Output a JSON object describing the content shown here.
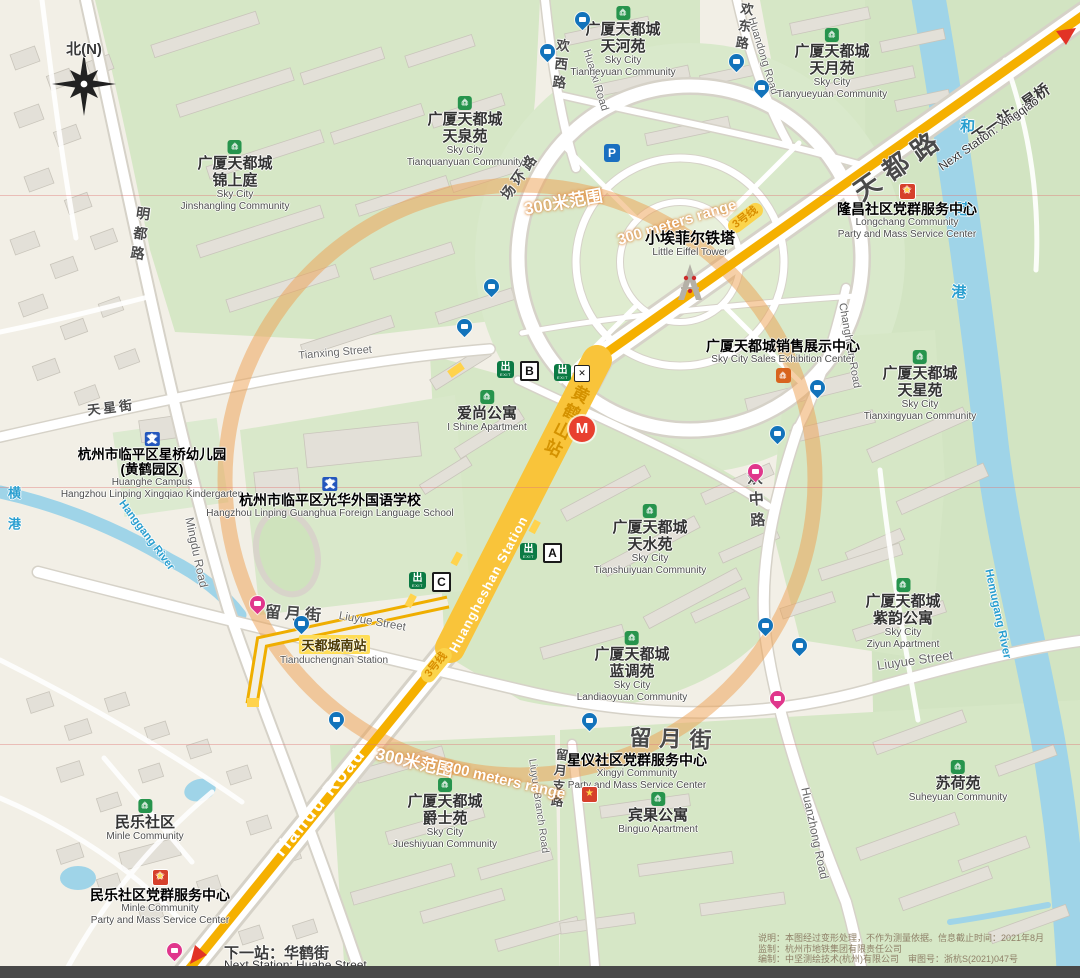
{
  "compass": {
    "label": "北(N)"
  },
  "parking_label": "P",
  "metro": {
    "logo": "M",
    "line_badge": "3号线",
    "station_zh": "黄鹤山站",
    "station_en": "Huangheshan Station"
  },
  "exits": {
    "glyph": "出",
    "sub": "EXIT",
    "a": "A",
    "b": "B",
    "c": "C",
    "elevator_glyph": "✕"
  },
  "range_circle": {
    "zh": "300米范围",
    "en": "300 meters range"
  },
  "next_station_ne": {
    "zh": "下一站：星桥",
    "en": "Next Station: Xingqiao"
  },
  "next_station_sw": {
    "zh": "下一站：华鹤街",
    "en": "Next Station: Huahe Street"
  },
  "bus_station": {
    "zh": "天都城南站",
    "en": "Tianduchengnan Station"
  },
  "landmark": {
    "zh": "小埃菲尔铁塔",
    "en": "Little Eiffel Tower"
  },
  "roads": {
    "tiandu_zh": "天都路",
    "tiandu_en": "Tiandu Road",
    "mingdu_zh": "明都路",
    "mingdu_en": "Mingdu Road",
    "tianxing_zh": "天星街",
    "tianxing_en": "Tianxing Street",
    "huanxi_zh": "欢西路",
    "huanxi_en": "Huanxi Road",
    "huandong_zh": "欢东路",
    "huandong_en": "Huandong Road",
    "changhuan_zh": "场环路",
    "changhuan_en": "Changhuan Road",
    "huanzhong_zh": "欢中路",
    "huanzhong_en": "Huanzhong Road",
    "liuyue_zh": "留月街",
    "liuyue_en": "Liuyue Street",
    "liuyue_branch_zh": "留月支路",
    "liuyue_branch_en": "Liuyue Branch Road"
  },
  "rivers": {
    "hanggang_zh": "横港",
    "hanggang_en": "Hanggang River",
    "hemugang_zh": "和睦港",
    "hemugang_en": "Hemugang River"
  },
  "communities": [
    {
      "zh1": "广厦天都城",
      "zh2": "锦上庭",
      "en1": "Sky City",
      "en2": "Jinshangling Community"
    },
    {
      "zh1": "广厦天都城",
      "zh2": "天泉苑",
      "en1": "Sky City",
      "en2": "Tianquanyuan Community"
    },
    {
      "zh1": "广厦天都城",
      "zh2": "天河苑",
      "en1": "Sky City",
      "en2": "Tianheyuan Community"
    },
    {
      "zh1": "广厦天都城",
      "zh2": "天月苑",
      "en1": "Sky City",
      "en2": "Tianyueyuan Community"
    },
    {
      "zh1": "广厦天都城",
      "zh2": "天星苑",
      "en1": "Sky City",
      "en2": "Tianxingyuan Community"
    },
    {
      "zh1": "广厦天都城",
      "zh2": "天水苑",
      "en1": "Sky City",
      "en2": "Tianshuiyuan Community"
    },
    {
      "zh1": "广厦天都城",
      "zh2": "紫韵公寓",
      "en1": "Sky City",
      "en2": "Ziyun Apartment"
    },
    {
      "zh1": "广厦天都城",
      "zh2": "蓝调苑",
      "en1": "Sky City",
      "en2": "Landiaoyuan Community"
    },
    {
      "zh1": "广厦天都城",
      "zh2": "爵士苑",
      "en1": "Sky City",
      "en2": "Jueshiyuan Community"
    }
  ],
  "apartments": [
    {
      "zh": "爱尚公寓",
      "en": "I Shine Apartment"
    },
    {
      "zh": "宾果公寓",
      "en": "Binguo Apartment"
    },
    {
      "zh": "苏荷苑",
      "en": "Suheyuan Community"
    },
    {
      "zh": "民乐社区",
      "en": "Minle Community"
    }
  ],
  "schools": [
    {
      "zh1": "杭州市临平区星桥幼儿园",
      "zh2": "(黄鹤园区)",
      "en1": "Huanghe Campus",
      "en2": "Hangzhou Linping Xingqiao Kindergarten"
    },
    {
      "zh1": "杭州市临平区光华外国语学校",
      "en1": "Hangzhou Linping Guanghua Foreign Language School"
    }
  ],
  "party_centers": [
    {
      "zh": "隆昌社区党群服务中心",
      "en1": "Longchang Community",
      "en2": "Party and Mass Service Center"
    },
    {
      "zh": "星仪社区党群服务中心",
      "en1": "Xingyi Community",
      "en2": "Party and Mass Service Center"
    },
    {
      "zh": "民乐社区党群服务中心",
      "en1": "Minle Community",
      "en2": "Party and Mass Service Center"
    }
  ],
  "sales_center": {
    "zh": "广厦天都城销售展示中心",
    "en": "Sky City Sales Exhibition Center"
  },
  "icons": {
    "community": "⌂",
    "school": "文",
    "party": "★",
    "sales": "⌂"
  },
  "disclaimer": {
    "line1": "说明：本图经过变形处理，不作为测量依据。信息截止时间：2021年8月",
    "line2": "监制：杭州市地铁集团有限责任公司",
    "line3": "编制：中坚测绘技术(杭州)有限公司　审图号：浙杭S(2021)047号"
  }
}
